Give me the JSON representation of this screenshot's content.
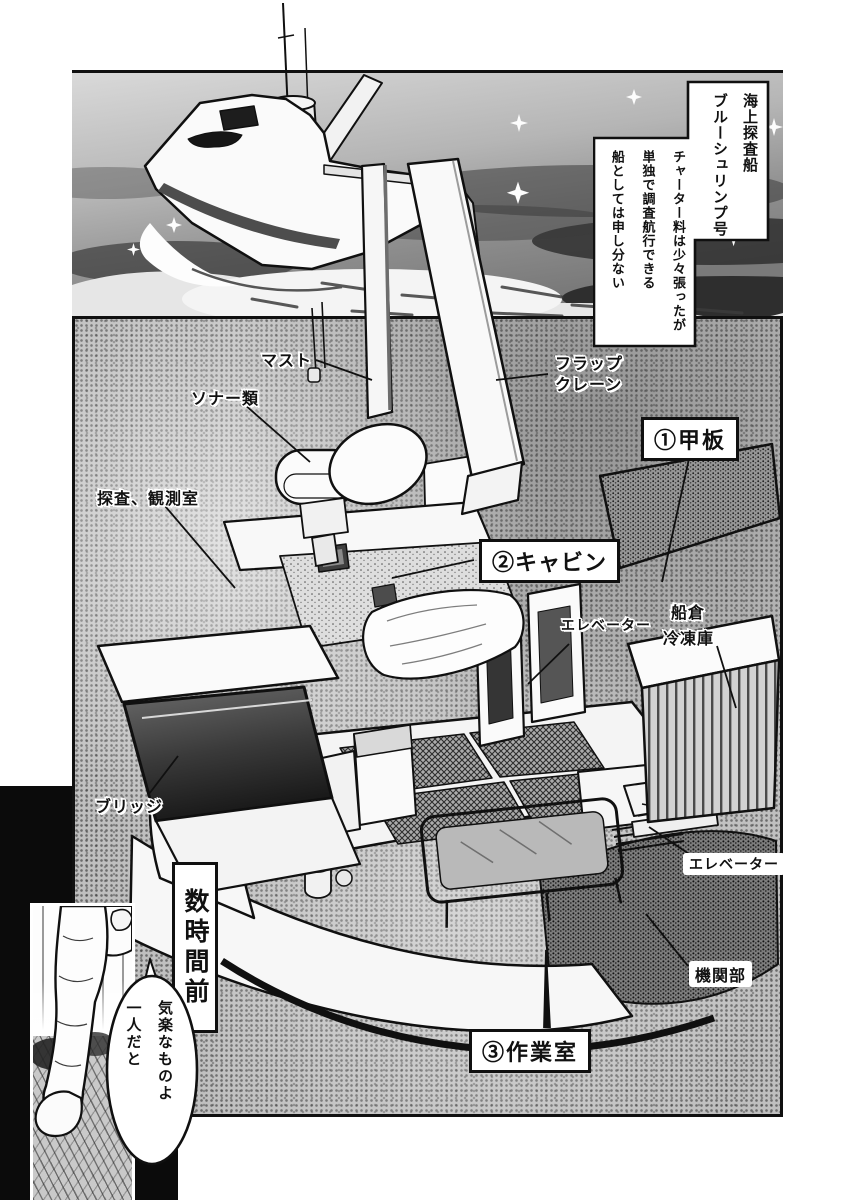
{
  "caption": {
    "title_lines": [
      "海上探査船",
      "ブルーシュリンプ号"
    ],
    "body_lines": [
      "チャーター料は少々張ったが",
      "単独で調査航行できる",
      "船としては申し分ない"
    ]
  },
  "diagram_labels": {
    "mast": "マスト",
    "sonar": "ソナー類",
    "flap_crane": [
      "フラップ",
      "クレーン"
    ],
    "deck": "①甲板",
    "survey_room": "探査、観測室",
    "cabin": "②キャビン",
    "elevator_upper": "エレベーター",
    "hold": "船倉",
    "freezer": "冷凍庫",
    "bridge": "ブリッジ",
    "elevator_lower": "エレベーター",
    "engine_room": "機関部",
    "work_room": "③作業室"
  },
  "flashback": {
    "narration": "数時間前",
    "speech_lines": [
      "気楽なものよ",
      "一人だと"
    ]
  },
  "colors": {
    "ink": "#101010",
    "paper": "#ffffff",
    "halftone": "#bfbfbf",
    "sea_dark": "#2d2d2d"
  }
}
